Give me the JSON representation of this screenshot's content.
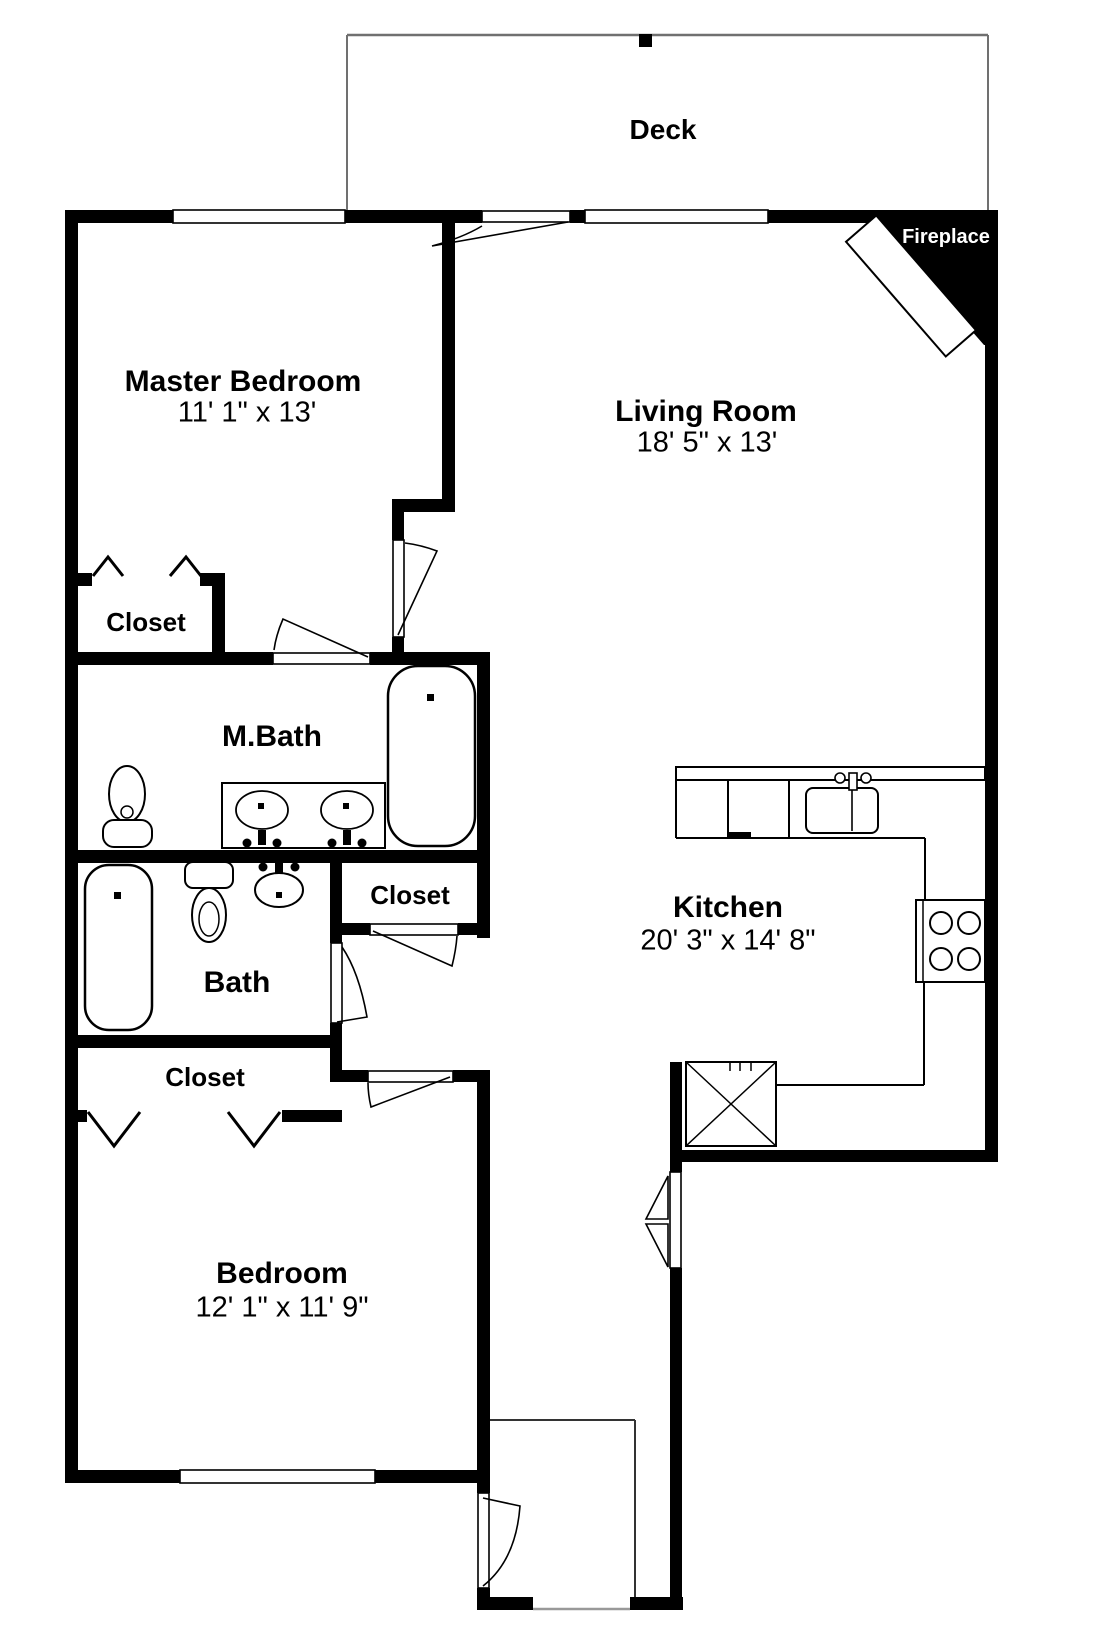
{
  "rooms": {
    "deck": {
      "label": "Deck"
    },
    "master_bedroom": {
      "label": "Master Bedroom",
      "dimensions": "11' 1\" x 13'"
    },
    "living_room": {
      "label": "Living Room",
      "dimensions": "18' 5\" x 13'"
    },
    "master_closet": {
      "label": "Closet"
    },
    "master_bath": {
      "label": "M.Bath"
    },
    "hall_closet": {
      "label": "Closet"
    },
    "bath": {
      "label": "Bath"
    },
    "bedroom_closet": {
      "label": "Closet"
    },
    "kitchen": {
      "label": "Kitchen",
      "dimensions": "20' 3\" x 14' 8\""
    },
    "bedroom": {
      "label": "Bedroom",
      "dimensions": "12' 1\" x 11' 9\""
    },
    "fireplace": {
      "label": "Fireplace"
    }
  },
  "fixtures": [
    "bathtub",
    "bathtub",
    "pedestal-sink",
    "double-vanity",
    "toilet",
    "oval-sink",
    "kitchen-sink",
    "dishwasher",
    "stove",
    "refrigerator",
    "fireplace",
    "bifold-closet-doors",
    "door-swings",
    "windows"
  ],
  "colors": {
    "wall": "#000000",
    "background": "#ffffff",
    "fireplace_text": "#ffffff",
    "deck_outline": "#707070"
  }
}
